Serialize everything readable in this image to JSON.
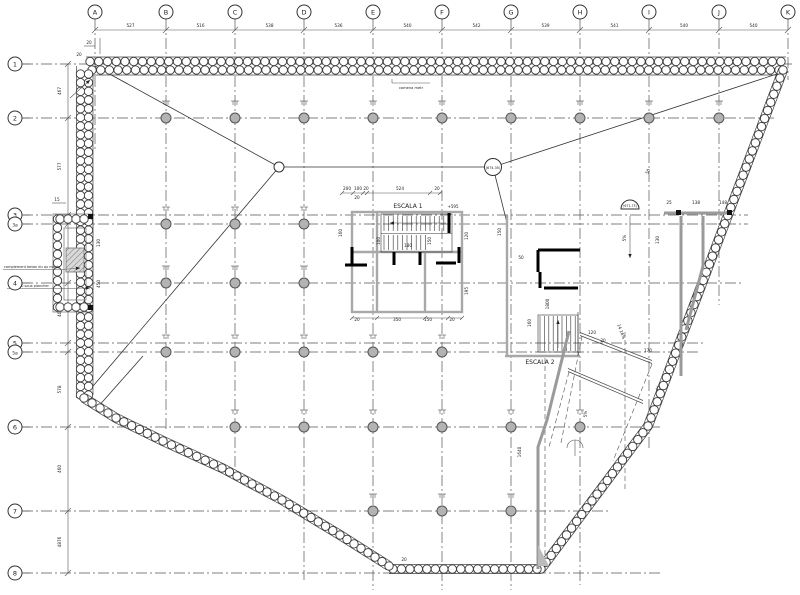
{
  "drawing": {
    "title": "basement floor plan with secant pile wall",
    "grid_cols": {
      "letters": [
        "A",
        "B",
        "C",
        "D",
        "E",
        "F",
        "G",
        "H",
        "I",
        "J",
        "K"
      ],
      "dims": [
        "527",
        "516",
        "538",
        "536",
        "540",
        "542",
        "539",
        "541",
        "540",
        "540"
      ]
    },
    "grid_rows": {
      "labels": [
        "1",
        "2",
        "3",
        "3a",
        "4",
        "5",
        "5a",
        "6",
        "7",
        "8"
      ],
      "dims": [
        "467",
        "577",
        "463",
        "408",
        "578",
        "460",
        "4876"
      ]
    },
    "labels": {
      "escala1": "ESCALA 1",
      "escala2": "ESCALA 2",
      "level_node": "674.35",
      "level_mark": "671.73",
      "top_note": "comena metr",
      "note1": "complement beton du au moule",
      "note2": "100 x 90 sous plancher",
      "plus_level": "+595",
      "ramp_grade": "14 16%"
    },
    "dims": [
      {
        "t": "20",
        "x": 89,
        "y": 44,
        "r": 0
      },
      {
        "t": "20",
        "x": 79,
        "y": 56,
        "r": 0
      },
      {
        "t": "15",
        "x": 57,
        "y": 201,
        "r": 0
      },
      {
        "t": "200",
        "x": 347,
        "y": 190,
        "r": 0
      },
      {
        "t": "100",
        "x": 358,
        "y": 190,
        "r": 0
      },
      {
        "t": "20",
        "x": 366,
        "y": 190,
        "r": 0
      },
      {
        "t": "524",
        "x": 400,
        "y": 190,
        "r": 0
      },
      {
        "t": "20",
        "x": 437,
        "y": 190,
        "r": 0
      },
      {
        "t": "20",
        "x": 357,
        "y": 199,
        "r": 0
      },
      {
        "t": "160",
        "x": 342,
        "y": 233,
        "r": -90
      },
      {
        "t": "100",
        "x": 380,
        "y": 241,
        "r": -90
      },
      {
        "t": "180",
        "x": 408,
        "y": 247,
        "r": 0
      },
      {
        "t": "150",
        "x": 431,
        "y": 241,
        "r": -90
      },
      {
        "t": "120",
        "x": 468,
        "y": 236,
        "r": -90
      },
      {
        "t": "195",
        "x": 468,
        "y": 291,
        "r": -90
      },
      {
        "t": "20",
        "x": 357,
        "y": 321,
        "r": 0
      },
      {
        "t": "350",
        "x": 397,
        "y": 321,
        "r": 0
      },
      {
        "t": "150",
        "x": 428,
        "y": 321,
        "r": 0
      },
      {
        "t": "20",
        "x": 452,
        "y": 321,
        "r": 0
      },
      {
        "t": "150",
        "x": 501,
        "y": 232,
        "r": -90
      },
      {
        "t": "50",
        "x": 521,
        "y": 259,
        "r": 0
      },
      {
        "t": "1800",
        "x": 549,
        "y": 304,
        "r": -90
      },
      {
        "t": "160",
        "x": 531,
        "y": 323,
        "r": -90
      },
      {
        "t": "25",
        "x": 669,
        "y": 204,
        "r": 0
      },
      {
        "t": "138",
        "x": 696,
        "y": 204,
        "r": 0
      },
      {
        "t": "148",
        "x": 723,
        "y": 204,
        "r": 0
      },
      {
        "t": "130",
        "x": 659,
        "y": 240,
        "r": -90
      },
      {
        "t": "5%",
        "x": 626,
        "y": 238,
        "r": -90
      },
      {
        "t": "5%",
        "x": 587,
        "y": 414,
        "r": -90
      },
      {
        "t": "120",
        "x": 592,
        "y": 334,
        "r": 0
      },
      {
        "t": "20",
        "x": 603,
        "y": 342,
        "r": 0
      },
      {
        "t": "170",
        "x": 648,
        "y": 352,
        "r": 0
      },
      {
        "t": "45",
        "x": 659,
        "y": 389,
        "r": -60
      },
      {
        "t": "1640",
        "x": 521,
        "y": 452,
        "r": -90
      },
      {
        "t": "20",
        "x": 404,
        "y": 561,
        "r": 0
      },
      {
        "t": "50",
        "x": 649,
        "y": 172,
        "r": -65
      },
      {
        "t": "14 16%",
        "x": 620,
        "y": 332,
        "r": 70
      },
      {
        "t": "130",
        "x": 100,
        "y": 243,
        "r": -90
      },
      {
        "t": "450",
        "x": 100,
        "y": 284,
        "r": -90
      }
    ]
  }
}
